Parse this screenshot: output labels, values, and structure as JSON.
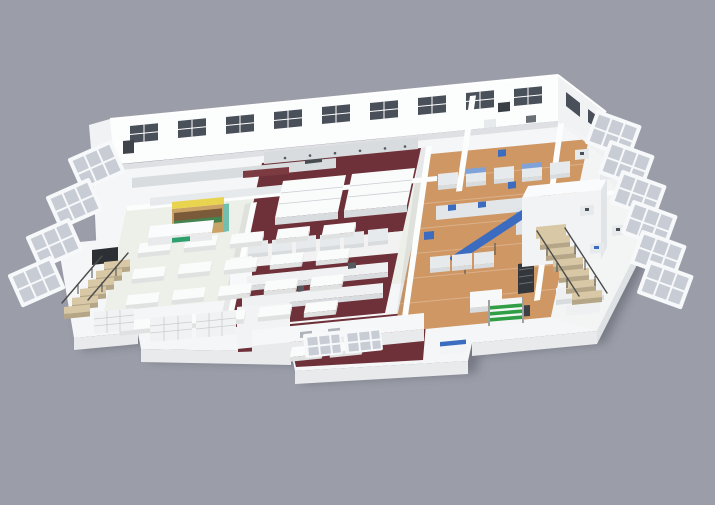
{
  "scene": {
    "kind": "isometric-3d-cutaway-floor-plan-render",
    "visible_text": "none (only a tiny illegible green logo on the serving counter)"
  },
  "colors": {
    "bg": "#9b9ea9",
    "slab": "#f5f6f7",
    "slabF": "#e8eaec",
    "slabS": "#dfe2e5",
    "wall": "#fcfdfd",
    "wallSh": "#f0f2f3",
    "wallDk": "#e2e5e7",
    "dining": "#edefe9",
    "maroon": "#6e3139",
    "wood": "#cf9763",
    "equip": "#e7eaec",
    "equipM": "#d8dcdf",
    "equipD": "#474c52",
    "blue": "#3b6cc0",
    "blueL": "#7fa3d8",
    "yellow": "#e9d44f",
    "wshelf": "#caa265",
    "sBrown": "#7a5a38",
    "sGreen": "#46824f",
    "sTan": "#c2a768",
    "teal": "#6fc0ae",
    "logo": "#2ea06b",
    "green": "#2f9e44",
    "step": "#d8c8a6",
    "stepD": "#b5a687",
    "rail": "#4c4c4c",
    "pane": "#c7ccd5",
    "frame": "#f7f8fa",
    "glass": "#4a505a",
    "dark": "#2c2f33",
    "shadow": "#3a3e46"
  },
  "zones": [
    {
      "id": "dining-hall",
      "floor_color": "#edefe9",
      "tables": {
        "rows": 4,
        "cols": 5,
        "extra": 2
      }
    },
    {
      "id": "serving-counter",
      "logo_color": "#2ea06b"
    },
    {
      "id": "retail-shelf",
      "accent_color": "#e9d44f"
    },
    {
      "id": "kitchen-north",
      "floor_color": "#6e3139"
    },
    {
      "id": "service-corridor",
      "floor_color": "#f1f2f1"
    },
    {
      "id": "kitchen-central",
      "floor_color": "#6e3139"
    },
    {
      "id": "kitchen-south",
      "floor_color": "#6e3139"
    },
    {
      "id": "processing-line",
      "floor_color": "#cf9763",
      "accent_color": "#3b6cc0"
    },
    {
      "id": "cold-room",
      "color": "#f2f3f5"
    },
    {
      "id": "east-lab-wing",
      "floor_color": "#f3f4f4"
    },
    {
      "id": "northwest-prep-wing",
      "floor_color": "#f5f6f7"
    },
    {
      "id": "northeast-lab-rooms"
    },
    {
      "id": "stair-west"
    },
    {
      "id": "stair-east"
    },
    {
      "id": "window-bays-west",
      "count": 4
    },
    {
      "id": "window-bays-east",
      "count": 6
    },
    {
      "id": "tray-cart",
      "slat_color": "#2f9e44"
    },
    {
      "id": "building-shell",
      "wall_windows": 9
    }
  ]
}
